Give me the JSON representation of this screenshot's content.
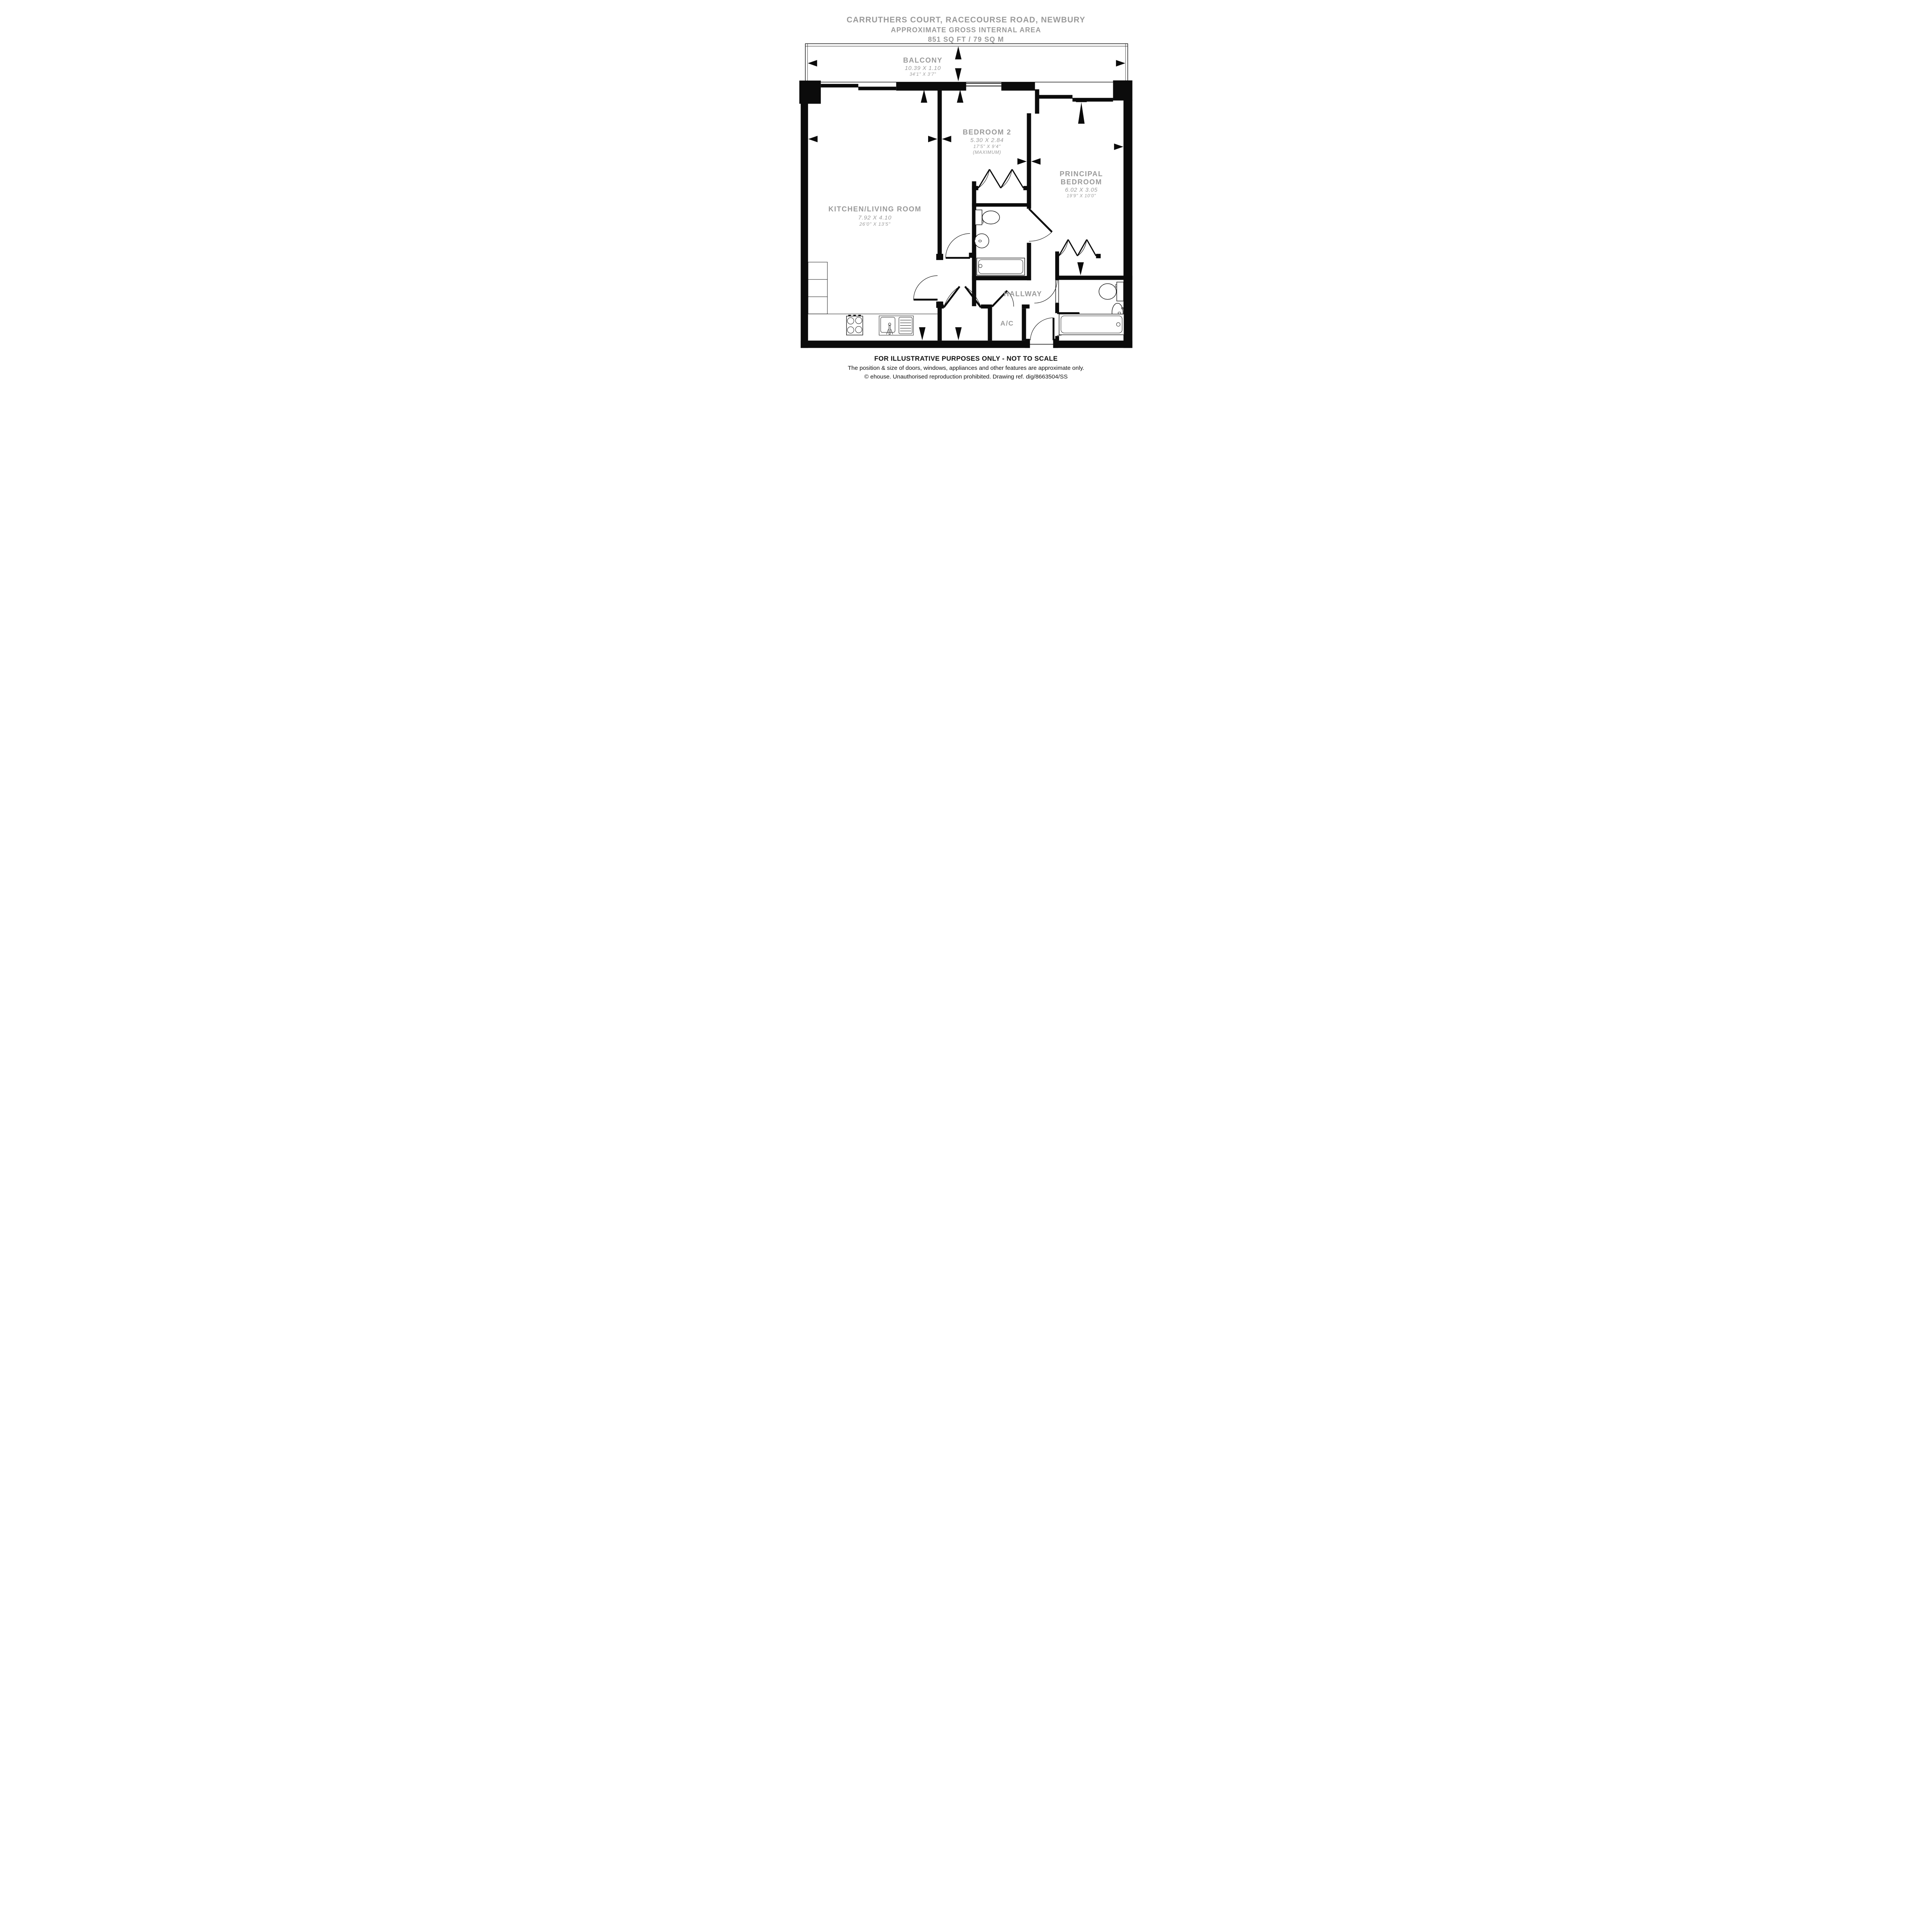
{
  "title": {
    "line1": "CARRUTHERS COURT, RACECOURSE ROAD, NEWBURY",
    "line2": "APPROXIMATE GROSS INTERNAL AREA",
    "line3": "851 SQ FT / 79 SQ M"
  },
  "rooms": {
    "balcony": {
      "name": "BALCONY",
      "metric": "10.39 X 1.10",
      "imperial": "34'1\" X 3'7\""
    },
    "kitchen_living": {
      "name": "KITCHEN/LIVING ROOM",
      "metric": "7.92 X 4.10",
      "imperial": "26'0\" X 13'5\""
    },
    "bedroom2": {
      "name": "BEDROOM 2",
      "metric": "5.30 X 2.84",
      "imperial": "17'5\" X 9'4\"",
      "note": "(MAXIMUM)"
    },
    "principal_bedroom": {
      "name_line1": "PRINCIPAL",
      "name_line2": "BEDROOM",
      "metric": "6.02 X 3.05",
      "imperial": "19'9\" X 10'0\""
    },
    "hallway": {
      "name": "HALLWAY"
    },
    "ac": {
      "name": "A/C"
    }
  },
  "footer": {
    "line1": "FOR ILLUSTRATIVE PURPOSES ONLY - NOT TO SCALE",
    "line2": "The position & size of doors, windows, appliances and other features are approximate only.",
    "line3": "© ehouse. Unauthorised reproduction prohibited. Drawing ref. dig/8663504/SS"
  },
  "colors": {
    "wall": "#0b0b0b",
    "label_gray": "#9a9a9a",
    "footer_black": "#111111",
    "background": "#ffffff"
  },
  "icons": {
    "hob": "four-burner-hob",
    "kitchen_sink": "sink-with-drainer",
    "bath": "bathtub",
    "toilet": "toilet-with-cistern",
    "basin": "wash-basin",
    "wardrobe": "bifold-wardrobe-doors",
    "door": "door-swing-arc",
    "dimension_arrow": "solid-triangle-marker"
  }
}
